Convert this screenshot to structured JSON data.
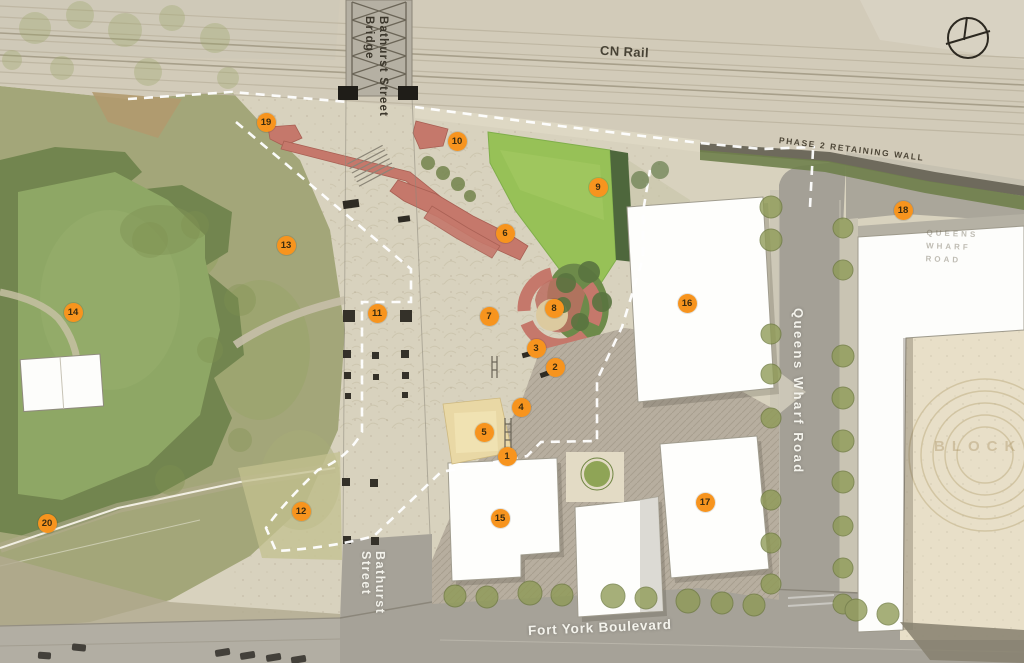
{
  "labels": {
    "cn_rail": "CN Rail",
    "bathurst_bridge": "Bathurst Street\nBridge",
    "retaining_wall": "PHASE 2 RETAINING WALL",
    "queens_wharf_road": "Queens Wharf Road",
    "queens_wharf_faint": "QUEENS WHARF\nROAD",
    "fort_york_blvd": "Fort York Boulevard",
    "bathurst_street": "Bathurst Street",
    "block_watermark": "BLOCK"
  },
  "markers": [
    {
      "n": 1,
      "x": 507,
      "y": 456
    },
    {
      "n": 2,
      "x": 555,
      "y": 367
    },
    {
      "n": 3,
      "x": 536,
      "y": 348
    },
    {
      "n": 4,
      "x": 521,
      "y": 407
    },
    {
      "n": 5,
      "x": 484,
      "y": 432
    },
    {
      "n": 6,
      "x": 505,
      "y": 233
    },
    {
      "n": 7,
      "x": 489,
      "y": 316
    },
    {
      "n": 8,
      "x": 554,
      "y": 308
    },
    {
      "n": 9,
      "x": 598,
      "y": 187
    },
    {
      "n": 10,
      "x": 457,
      "y": 141
    },
    {
      "n": 11,
      "x": 377,
      "y": 313
    },
    {
      "n": 12,
      "x": 301,
      "y": 511
    },
    {
      "n": 13,
      "x": 286,
      "y": 245
    },
    {
      "n": 14,
      "x": 73,
      "y": 312
    },
    {
      "n": 15,
      "x": 500,
      "y": 518
    },
    {
      "n": 16,
      "x": 687,
      "y": 303
    },
    {
      "n": 17,
      "x": 705,
      "y": 502
    },
    {
      "n": 18,
      "x": 903,
      "y": 210
    },
    {
      "n": 19,
      "x": 266,
      "y": 122
    },
    {
      "n": 20,
      "x": 47,
      "y": 523
    }
  ],
  "colors": {
    "marker_bg": "#F7941E",
    "marker_text": "#3A2B10",
    "boundary_dash": "#FFFFFF",
    "lawn": "#97C157",
    "terrace_red": "#C5786B"
  }
}
